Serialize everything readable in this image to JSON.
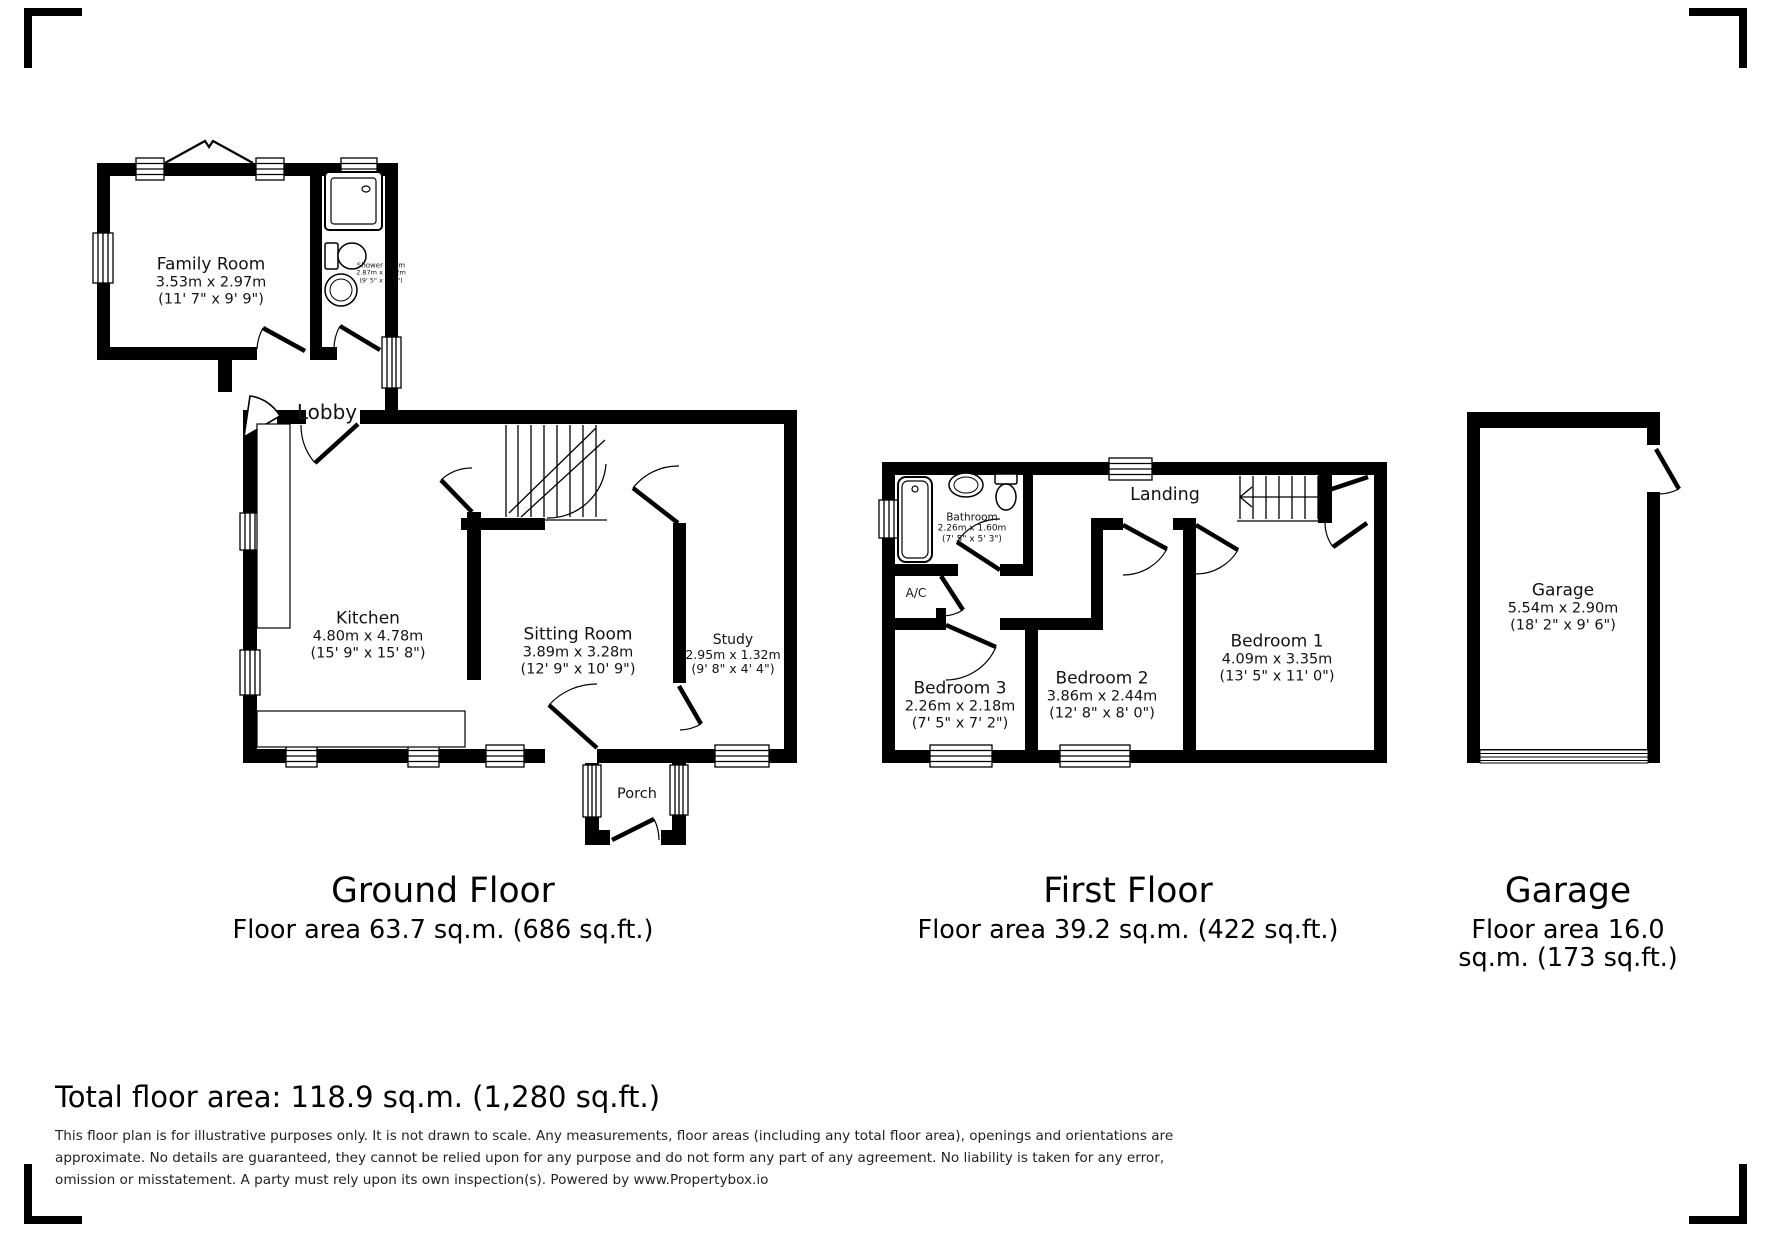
{
  "ground_floor": {
    "title": "Ground Floor",
    "area_label": "Floor area 63.7 sq.m. (686 sq.ft.)",
    "rooms": {
      "family_room": {
        "name": "Family Room",
        "metric": "3.53m x 2.97m",
        "imperial": "(11' 7\" x 9' 9\")"
      },
      "shower_room": {
        "name": "Shower Room",
        "metric": "2.87m x 1.52m",
        "imperial": "(9' 5\" x 5' 0\")"
      },
      "lobby": {
        "name": "Lobby"
      },
      "kitchen": {
        "name": "Kitchen",
        "metric": "4.80m x 4.78m",
        "imperial": "(15' 9\" x 15' 8\")"
      },
      "sitting_room": {
        "name": "Sitting Room",
        "metric": "3.89m x 3.28m",
        "imperial": "(12' 9\" x 10' 9\")"
      },
      "study": {
        "name": "Study",
        "metric": "2.95m x 1.32m",
        "imperial": "(9' 8\" x 4' 4\")"
      },
      "porch": {
        "name": "Porch"
      }
    }
  },
  "first_floor": {
    "title": "First Floor",
    "area_label": "Floor area 39.2 sq.m. (422 sq.ft.)",
    "rooms": {
      "bathroom": {
        "name": "Bathroom",
        "metric": "2.26m x 1.60m",
        "imperial": "(7' 5\" x 5' 3\")"
      },
      "ac": {
        "name": "A/C"
      },
      "landing": {
        "name": "Landing"
      },
      "bedroom1": {
        "name": "Bedroom 1",
        "metric": "4.09m x 3.35m",
        "imperial": "(13' 5\" x 11' 0\")"
      },
      "bedroom2": {
        "name": "Bedroom 2",
        "metric": "3.86m x 2.44m",
        "imperial": "(12' 8\" x 8' 0\")"
      },
      "bedroom3": {
        "name": "Bedroom 3",
        "metric": "2.26m x 2.18m",
        "imperial": "(7' 5\" x 7' 2\")"
      }
    }
  },
  "garage": {
    "title": "Garage",
    "area_lines": [
      "Floor area 16.0",
      "sq.m. (173 sq.ft.)"
    ],
    "room": {
      "name": "Garage",
      "metric": "5.54m x 2.90m",
      "imperial": "(18' 2\" x 9' 6\")"
    }
  },
  "footer": {
    "total": "Total floor area: 118.9 sq.m. (1,280 sq.ft.)",
    "disclaimer_lines": [
      "This floor plan is for illustrative purposes only. It is not drawn to scale. Any measurements, floor areas (including any total floor area), openings and orientations are",
      "approximate. No details are guaranteed, they cannot be relied upon for any purpose and do not form any part of any agreement. No liability is taken for any error,",
      "omission or misstatement. A party must rely upon its own inspection(s). Powered by www.Propertybox.io"
    ]
  },
  "colors": {
    "wall": "#000000",
    "background": "#ffffff",
    "text": "#131313"
  }
}
